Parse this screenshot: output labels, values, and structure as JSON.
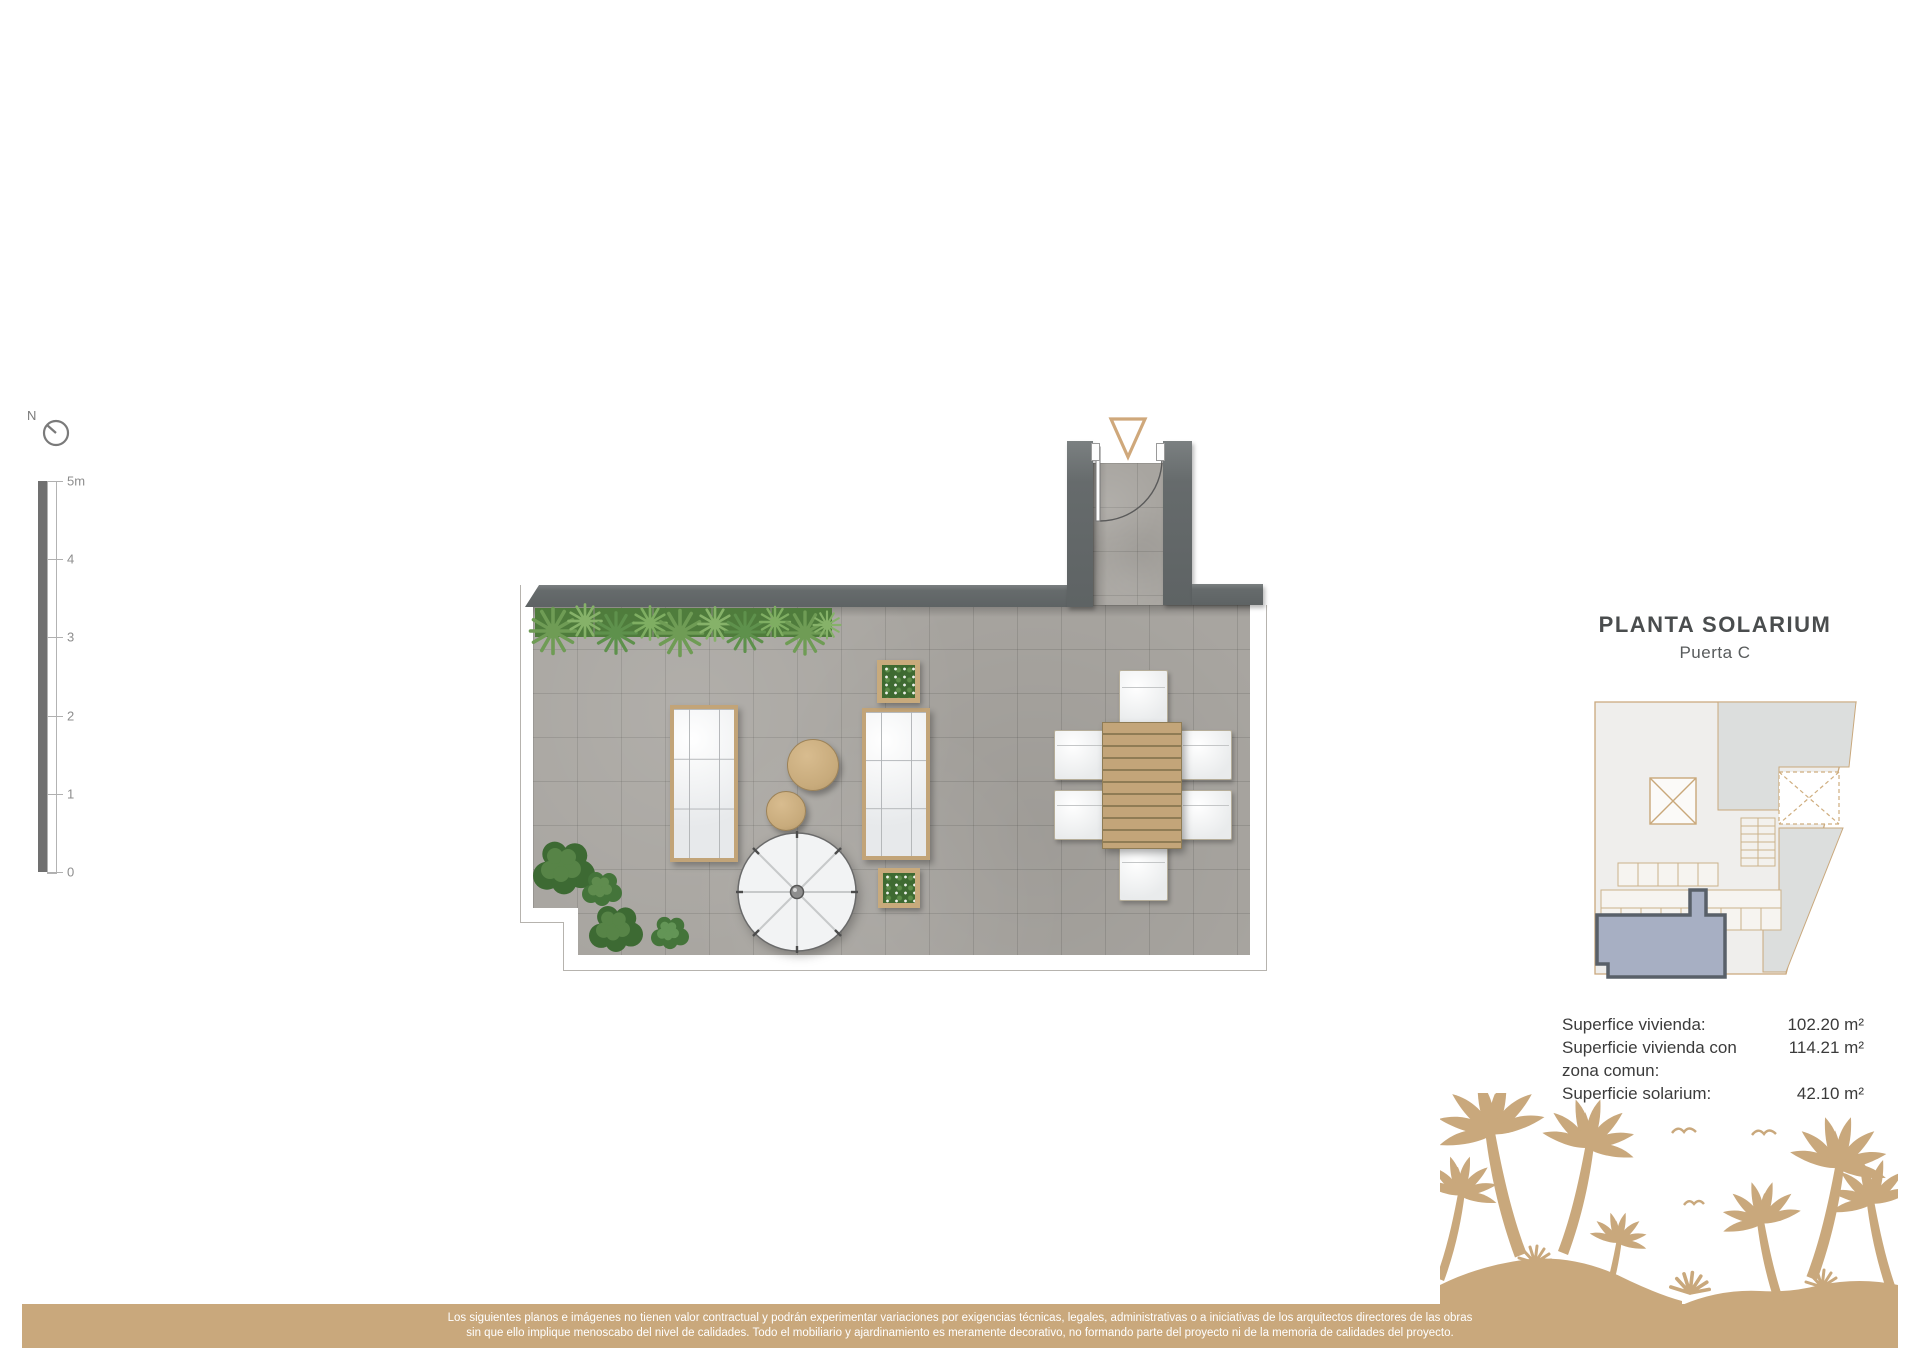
{
  "meta": {
    "title": "PLANTA SOLARIUM",
    "subtitle": "Puerta C"
  },
  "compass": {
    "label": "N"
  },
  "scale_bar": {
    "ticks": [
      "5m",
      "4",
      "3",
      "2",
      "1",
      "0"
    ]
  },
  "areas": {
    "rows": [
      {
        "label": "Superfice vivienda:",
        "value": "102.20 m²"
      },
      {
        "label": "Superficie vivienda con",
        "value": "114.21 m²"
      },
      {
        "label": "zona comun:",
        "value": ""
      },
      {
        "label": "Superficie solarium:",
        "value": "42.10 m²"
      }
    ]
  },
  "disclaimer": {
    "line1": "Los siguientes planos e imágenes no tienen valor contractual y podrán experimentar variaciones por exigencias técnicas, legales, administrativas o a iniciativas de los arquitectos directores de las obras",
    "line2": "sin que ello implique menoscabo del nivel de calidades. Todo el mobiliario y ajardinamiento es meramente decorativo, no formando parte del proyecto ni de la memoria de calidades del proyecto."
  },
  "plan": {
    "label": "solarium-terrace-floor-plan",
    "items": [
      "entry-vestibule",
      "entry-marker",
      "door-swing",
      "hedge-planter",
      "sun-lounger-left",
      "sun-lounger-right",
      "pouf-table-large",
      "pouf-table-small",
      "parasol-umbrella",
      "square-planter-top",
      "square-planter-bottom",
      "dining-table",
      "dining-chairs",
      "shrubs"
    ]
  },
  "key_plan": {
    "label": "building-key-plan",
    "highlighted_unit": "Puerta C solarium"
  },
  "colors": {
    "accent_tan": "#c9a87c",
    "wall_gray": "#666b6c",
    "floor_gray": "#a8a5a0",
    "hedge_lawn": "#4f7c3c",
    "plant_green": "#6f9c55",
    "unit_highlight": "#a7afc3",
    "text_dark": "#3c3c3c"
  }
}
